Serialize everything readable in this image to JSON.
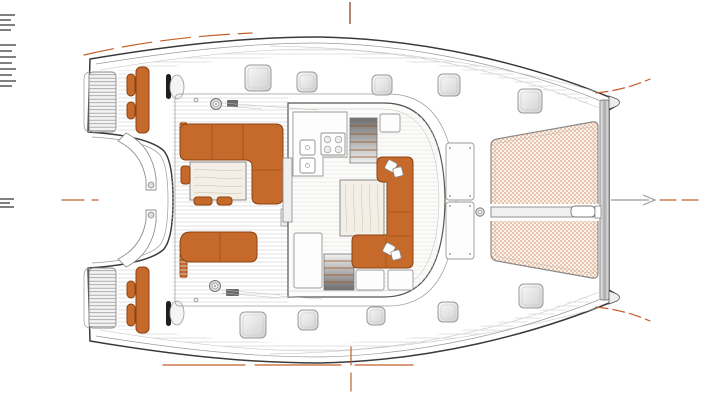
{
  "page": {
    "title": "Sailing catamaran deck plan — top view line drawing",
    "view": "top-down, bow pointing right",
    "background": "#ffffff"
  },
  "drawing": {
    "colors": {
      "hull_outline": "#3a3a3a",
      "secondary_line": "#9a9a9a",
      "cushion_orange": "#c56a2b",
      "cushion_border": "#8a4312",
      "cushion_seam": "#9c4f1b",
      "accent_dash": "#c2602a",
      "centerline_top": "#a06a50",
      "trampoline_base": "#fbf4ed",
      "trampoline_mesh": "#e9c3ab",
      "trampoline_edge": "#8a8a8a",
      "wood_fill": "#f3efe7",
      "wood_grain": "#d5cebd",
      "hatch_stroke": "#9a9a9a",
      "edge_tick": "#4a4a4a"
    },
    "areas": {
      "transoms": "twin swim-step transoms (hatched)",
      "helm_stations": "port and starboard helm seats with orange cushions and wheels",
      "cockpit": "aft cockpit: L-shaped orange settee, teak table, aft bench",
      "saloon": "saloon: chaise sofa with throw pillows around coffee table",
      "galley": "galley: twin sinks, four-burner stove, companionway stairs",
      "foredeck": "foredeck locker panels and anchor windlass",
      "trampoline": "bow trampoline with woven mesh and bowsprit beam",
      "crossbeam": "forward crossbeam joining both bows",
      "bow_arrow": "centerline heading arrow at bow"
    },
    "hatches": [
      [
        258,
        78,
        26
      ],
      [
        307,
        82,
        20
      ],
      [
        382,
        85,
        20
      ],
      [
        449,
        85,
        22
      ],
      [
        530,
        101,
        24
      ],
      [
        253,
        325,
        26
      ],
      [
        308,
        320,
        20
      ],
      [
        376,
        316,
        18
      ],
      [
        448,
        312,
        20
      ],
      [
        531,
        296,
        24
      ]
    ],
    "winches": [
      [
        216,
        104
      ],
      [
        215,
        286
      ]
    ],
    "helm_cushions": [
      [
        127,
        74,
        8,
        22
      ],
      [
        127,
        102,
        8,
        17
      ],
      [
        127,
        281,
        8,
        17
      ],
      [
        127,
        304,
        8,
        22
      ]
    ],
    "pillow_sets": [
      [
        391,
        166
      ],
      [
        389,
        249
      ]
    ],
    "edge_ticks": [
      {
        "x": 0,
        "w": 15,
        "ys": [
          15,
          20,
          25,
          30
        ]
      },
      {
        "x": 0,
        "w": 16,
        "ys": [
          45,
          51,
          57,
          63,
          69,
          75,
          81,
          86
        ]
      },
      {
        "x": 0,
        "w": 14,
        "ys": [
          199,
          203,
          207
        ]
      }
    ]
  }
}
